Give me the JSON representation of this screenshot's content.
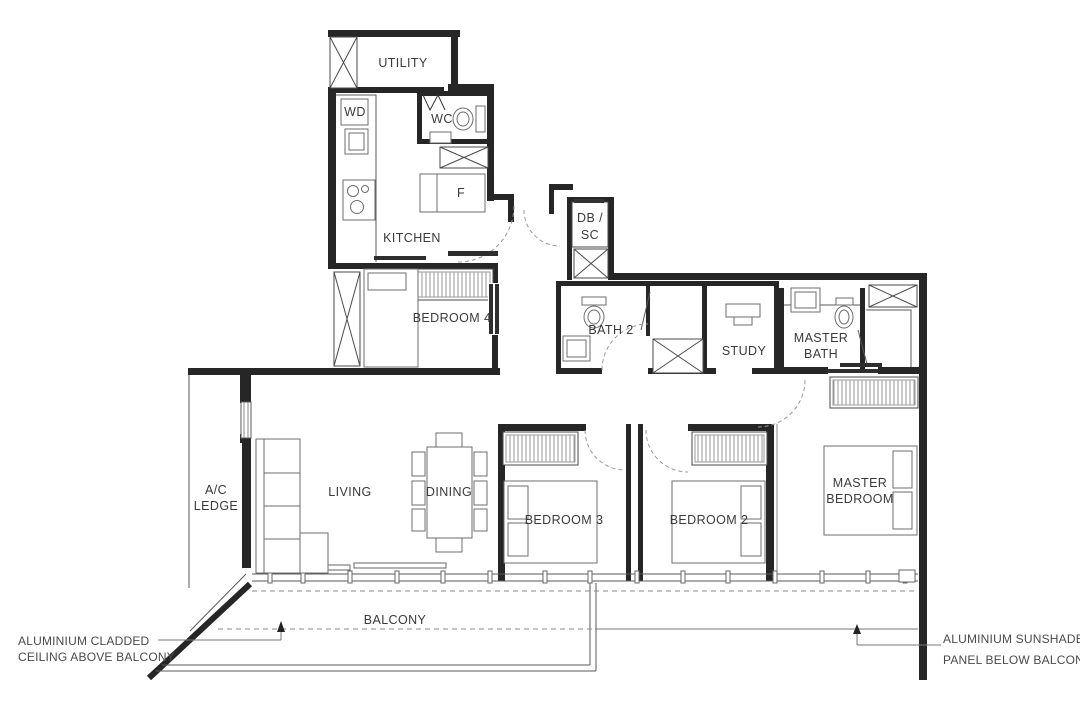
{
  "rooms": {
    "utility": "UTILITY",
    "wd": "WD",
    "wc": "WC",
    "fridge": "F",
    "kitchen": "KITCHEN",
    "db_sc_line1": "DB /",
    "db_sc_line2": "SC",
    "bedroom4": "BEDROOM 4",
    "bath2": "BATH 2",
    "study": "STUDY",
    "master_bath_line1": "MASTER",
    "master_bath_line2": "BATH",
    "ac_ledge_line1": "A/C",
    "ac_ledge_line2": "LEDGE",
    "living": "LIVING",
    "dining": "DINING",
    "bedroom3": "BEDROOM 3",
    "bedroom2": "BEDROOM 2",
    "master_bedroom_line1": "MASTER",
    "master_bedroom_line2": "BEDROOM",
    "balcony": "BALCONY"
  },
  "annotations": {
    "balcony_ceiling_line1": "ALUMINIUM CLADDED",
    "balcony_ceiling_line2": "CEILING ABOVE BALCONY",
    "sunshade_line1": "ALUMINIUM SUNSHADE",
    "sunshade_line2": "PANEL BELOW BALCONY"
  },
  "colors": {
    "background": "#ffffff",
    "wall": "#262626",
    "thin_line": "#5a5a5a",
    "furniture_line": "#6e6e6e",
    "hatch_line": "#9a9a9a",
    "dash_line": "#8a8a8a",
    "label_text": "#3a3a3a"
  }
}
